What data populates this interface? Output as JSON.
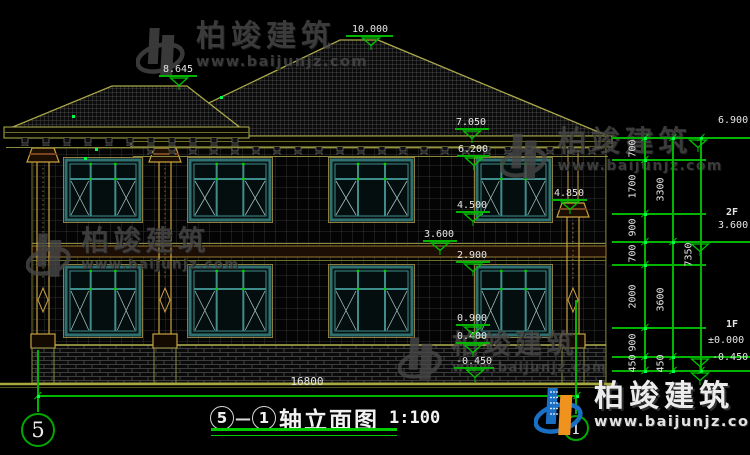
{
  "title_block": {
    "axis_from": "5",
    "axis_to": "1",
    "dash": "—",
    "name": "轴立面图",
    "scale": "1:100"
  },
  "watermark": {
    "brand": "柏竣建筑",
    "url": "www.baijunjz.com"
  },
  "colors": {
    "dim_green": "#00b400",
    "line_olive": "#aaa84a",
    "frame_teal": "#2f7070",
    "logo_blue": "#1a6fc4",
    "logo_orange": "#f0921e"
  },
  "bottom_dimension": {
    "label": "16800",
    "x": 283,
    "y": 375,
    "line_y": 396,
    "x1": 38,
    "x2": 577
  },
  "axis_bubbles": [
    {
      "label": "5",
      "cx": 38,
      "cy": 430,
      "r": 17,
      "fs": 21,
      "line_top": 350,
      "line_bot": 412
    },
    {
      "label": "1",
      "cx": 576,
      "cy": 428,
      "r": 13,
      "fs": 16,
      "line_top": 300,
      "line_bot": 414
    }
  ],
  "left_markers": [
    {
      "v": "10.000",
      "cx": 370,
      "y": 36,
      "x1": 346,
      "x2": 393
    },
    {
      "v": "8.645",
      "cx": 178,
      "y": 76,
      "x1": 159,
      "x2": 197
    },
    {
      "v": "7.050",
      "cx": 471,
      "y": 129,
      "x1": 455,
      "x2": 489
    },
    {
      "v": "6.200",
      "cx": 473,
      "y": 156,
      "x1": 457,
      "x2": 490
    },
    {
      "v": "4.850",
      "cx": 569,
      "y": 200,
      "x1": 552,
      "x2": 587
    },
    {
      "v": "4.500",
      "cx": 472,
      "y": 212,
      "x1": 456,
      "x2": 490
    },
    {
      "v": "3.600",
      "cx": 439,
      "y": 241,
      "x1": 423,
      "x2": 457
    },
    {
      "v": "2.900",
      "cx": 472,
      "y": 262,
      "x1": 456,
      "x2": 490
    },
    {
      "v": "0.900",
      "cx": 472,
      "y": 325,
      "x1": 456,
      "x2": 490
    },
    {
      "v": "0.400",
      "cx": 472,
      "y": 343,
      "x1": 456,
      "x2": 490
    },
    {
      "v": "-0.450",
      "cx": 474,
      "y": 368,
      "x1": 454,
      "x2": 494
    }
  ],
  "right_texts": [
    {
      "t": "6.900",
      "x": 718,
      "y": 115,
      "b": 0
    },
    {
      "t": "2F",
      "x": 726,
      "y": 207,
      "b": 1
    },
    {
      "t": "3.600",
      "x": 718,
      "y": 220,
      "b": 0
    },
    {
      "t": "1F",
      "x": 726,
      "y": 319,
      "b": 1
    },
    {
      "t": "±0.000",
      "x": 708,
      "y": 335,
      "b": 0
    },
    {
      "t": "-0.450",
      "x": 712,
      "y": 352,
      "b": 0
    }
  ],
  "right_tris": [
    {
      "x": 698,
      "y": 138
    },
    {
      "x": 700,
      "y": 242
    },
    {
      "x": 700,
      "y": 357
    },
    {
      "x": 700,
      "y": 371
    }
  ],
  "ext_lines": [
    {
      "y": 138,
      "x1": 612,
      "x2": 752
    },
    {
      "y": 160,
      "x1": 612,
      "x2": 706
    },
    {
      "y": 214,
      "x1": 612,
      "x2": 706
    },
    {
      "y": 242,
      "x1": 612,
      "x2": 752
    },
    {
      "y": 265,
      "x1": 612,
      "x2": 706
    },
    {
      "y": 328,
      "x1": 612,
      "x2": 706
    },
    {
      "y": 357,
      "x1": 612,
      "x2": 752
    },
    {
      "y": 371,
      "x1": 612,
      "x2": 752
    }
  ],
  "dim_chains": [
    {
      "x": 645,
      "bounds": [
        138,
        160,
        214,
        242,
        265,
        328,
        357,
        371
      ],
      "labels": [
        "700",
        "1700",
        "900",
        "700",
        "2000",
        "900",
        "450"
      ]
    },
    {
      "x": 673,
      "bounds": [
        138,
        242,
        357,
        371
      ],
      "labels": [
        "3300",
        "3600",
        "450"
      ]
    },
    {
      "x": 701,
      "bounds": [
        138,
        371
      ],
      "labels": [
        "7350"
      ]
    }
  ],
  "windows": [
    {
      "x": 66,
      "y": 160,
      "w": 74,
      "h": 60
    },
    {
      "x": 190,
      "y": 160,
      "w": 80,
      "h": 60
    },
    {
      "x": 331,
      "y": 160,
      "w": 81,
      "h": 60
    },
    {
      "x": 477,
      "y": 160,
      "w": 73,
      "h": 60
    },
    {
      "x": 66,
      "y": 267,
      "w": 74,
      "h": 68
    },
    {
      "x": 190,
      "y": 267,
      "w": 80,
      "h": 68
    },
    {
      "x": 331,
      "y": 267,
      "w": 81,
      "h": 68
    },
    {
      "x": 477,
      "y": 267,
      "w": 73,
      "h": 68
    }
  ],
  "columns": [
    {
      "x": 30,
      "cap": 148,
      "upper": 0
    },
    {
      "x": 152,
      "cap": 148,
      "upper": 0
    },
    {
      "x": 560,
      "cap": 203,
      "upper": 1
    }
  ],
  "green_dots": [
    [
      73,
      116
    ],
    [
      96,
      149
    ],
    [
      85,
      158
    ],
    [
      221,
      97
    ],
    [
      38,
      396
    ],
    [
      577,
      396
    ]
  ],
  "watermarks": [
    {
      "x": 136,
      "y": 22,
      "s": 1.0,
      "color": false
    },
    {
      "x": 500,
      "y": 128,
      "s": 0.96,
      "color": false
    },
    {
      "x": 26,
      "y": 228,
      "s": 0.92,
      "color": false
    },
    {
      "x": 398,
      "y": 332,
      "s": 0.9,
      "color": false
    },
    {
      "x": 534,
      "y": 382,
      "s": 1.0,
      "color": true
    }
  ]
}
